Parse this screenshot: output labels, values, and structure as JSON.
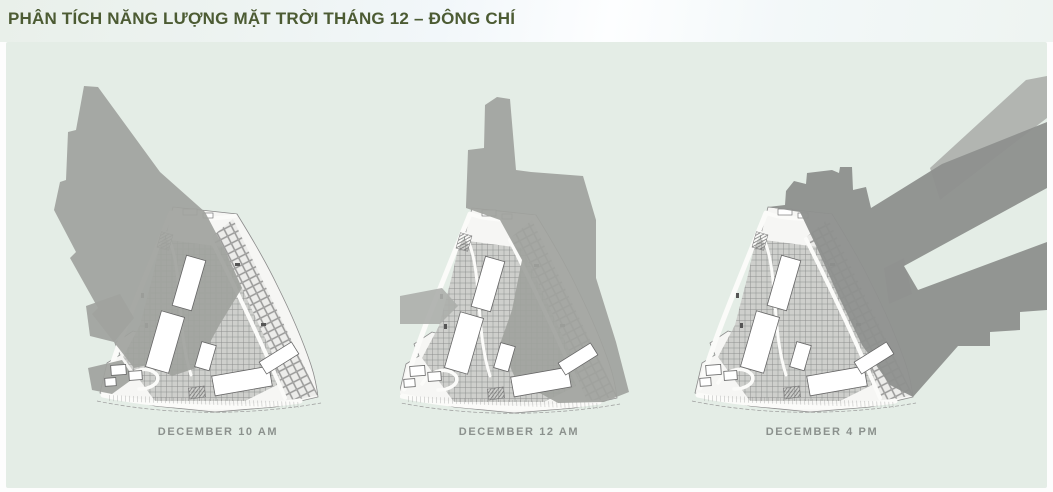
{
  "header": {
    "title": "PHÂN TÍCH NĂNG LƯỢNG MẶT TRỜI THÁNG 12 – ĐÔNG CHÍ"
  },
  "maps": [
    {
      "id": "december-10am",
      "label": "DECEMBER 10 AM",
      "time": "10 AM",
      "shadow_direction": "northwest"
    },
    {
      "id": "december-12am",
      "label": "DECEMBER 12 AM",
      "time": "12 AM",
      "shadow_direction": "north"
    },
    {
      "id": "december-4pm",
      "label": "DECEMBER 4 PM",
      "time": "4 PM",
      "shadow_direction": "northeast"
    }
  ],
  "colors": {
    "title": "#4c5b33",
    "panel_bg": "#e4ede6",
    "label": "#8b918d",
    "shadow": "#a0a29e",
    "shadow_dark": "#8f918f",
    "shadow_light": "#acaeab"
  }
}
